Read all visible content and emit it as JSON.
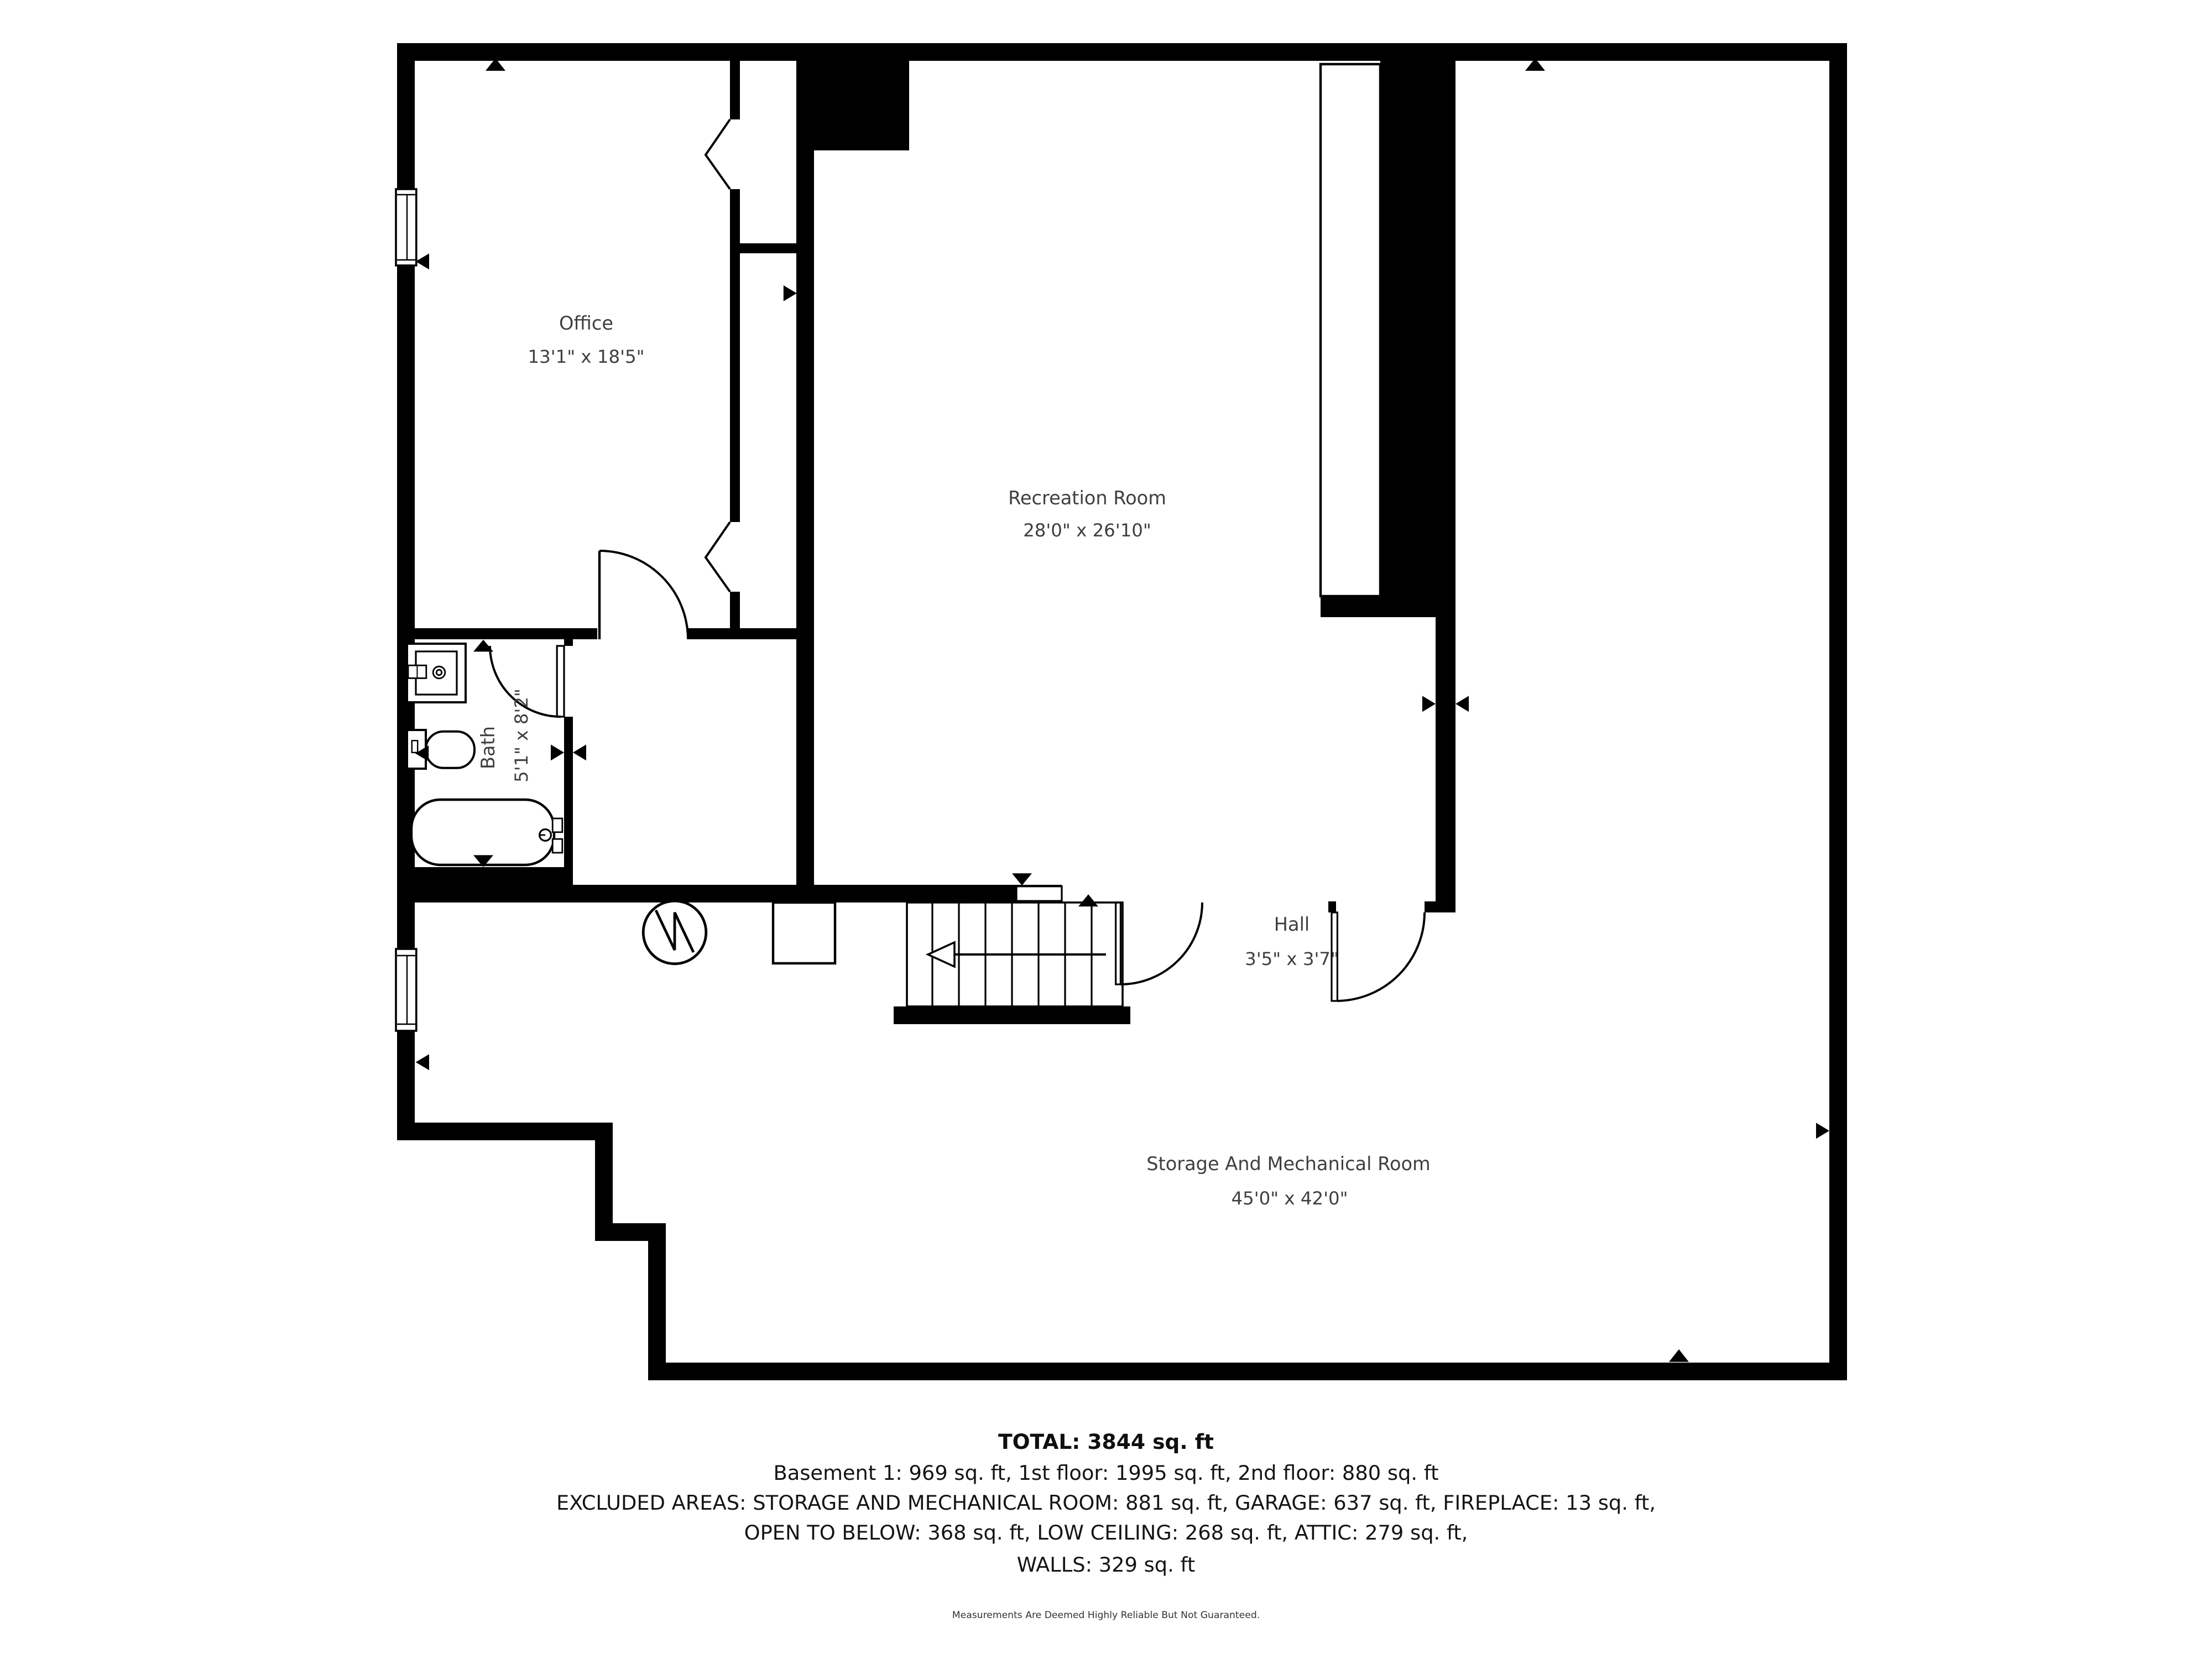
{
  "colors": {
    "background": "#ffffff",
    "walls": "#000000",
    "room_label_text": "#3f3f3f",
    "summary_text": "#141414"
  },
  "rooms": {
    "office": {
      "name": "Office",
      "dims": "13'1\" x 18'5\""
    },
    "recreation": {
      "name": "Recreation Room",
      "dims": "28'0\" x 26'10\""
    },
    "bath": {
      "name": "Bath",
      "dims": "5'1\" x 8'2\""
    },
    "hall": {
      "name": "Hall",
      "dims": "3'5\" x 3'7\""
    },
    "storage": {
      "name": "Storage And Mechanical Room",
      "dims": "45'0\" x 42'0\""
    }
  },
  "summary": {
    "total": "TOTAL: 3844 sq. ft",
    "floors": "Basement 1: 969 sq. ft, 1st floor: 1995 sq. ft, 2nd floor: 880 sq. ft",
    "excluded_1": "EXCLUDED AREAS: STORAGE AND MECHANICAL ROOM: 881 sq. ft, GARAGE: 637 sq. ft, FIREPLACE: 13 sq. ft,",
    "excluded_2": "OPEN TO BELOW: 368 sq. ft, LOW CEILING: 268 sq. ft, ATTIC: 279 sq. ft,",
    "excluded_3": "WALLS: 329 sq. ft"
  },
  "disclaimer": "Measurements Are Deemed Highly Reliable But Not Guaranteed."
}
